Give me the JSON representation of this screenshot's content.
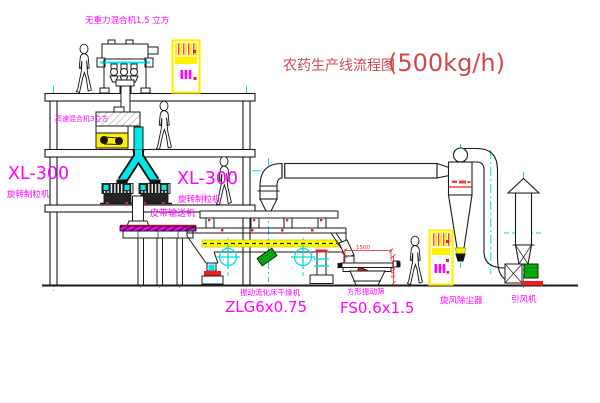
{
  "diagram_title": {
    "name_cn": "农药生产线流程图",
    "capacity": "(500kg/h)"
  },
  "equipment_labels": {
    "gravity_free_mixer": "无重力混合机1.5 立方",
    "high_speed_mixer": "高速混合机3立方",
    "granulator_left_model": "XL-300",
    "granulator_left_name": "旋转制粒机",
    "granulator_right_model": "XL-300",
    "granulator_right_name": "旋转制粒机",
    "belt_conveyor": "皮带输送机",
    "fluid_bed_dryer_name": "振动流化床干燥机",
    "fluid_bed_dryer_model": "ZLG6x0.75",
    "vibrating_screen_name": "方形振动筛",
    "vibrating_screen_model": "FS0.6x1.5",
    "cyclone_dust_collector": "旋风除尘器",
    "induced_draft_fan": "引风机"
  },
  "dimension_annotations": {
    "screen_length": "1500",
    "screen_height": "540"
  },
  "palette": {
    "line_black": "#1a1a1a",
    "centerline_cyan": "#00dddd",
    "pipe_fill_cyan": "#00e8e8",
    "label_magenta": "#ff00ff",
    "title_red": "#cf4a4a",
    "annotation_red": "#e82020",
    "cabinet_yellow": "#ffef00",
    "deck_yellow": "#ffff00",
    "motor_green": "#00b400"
  }
}
